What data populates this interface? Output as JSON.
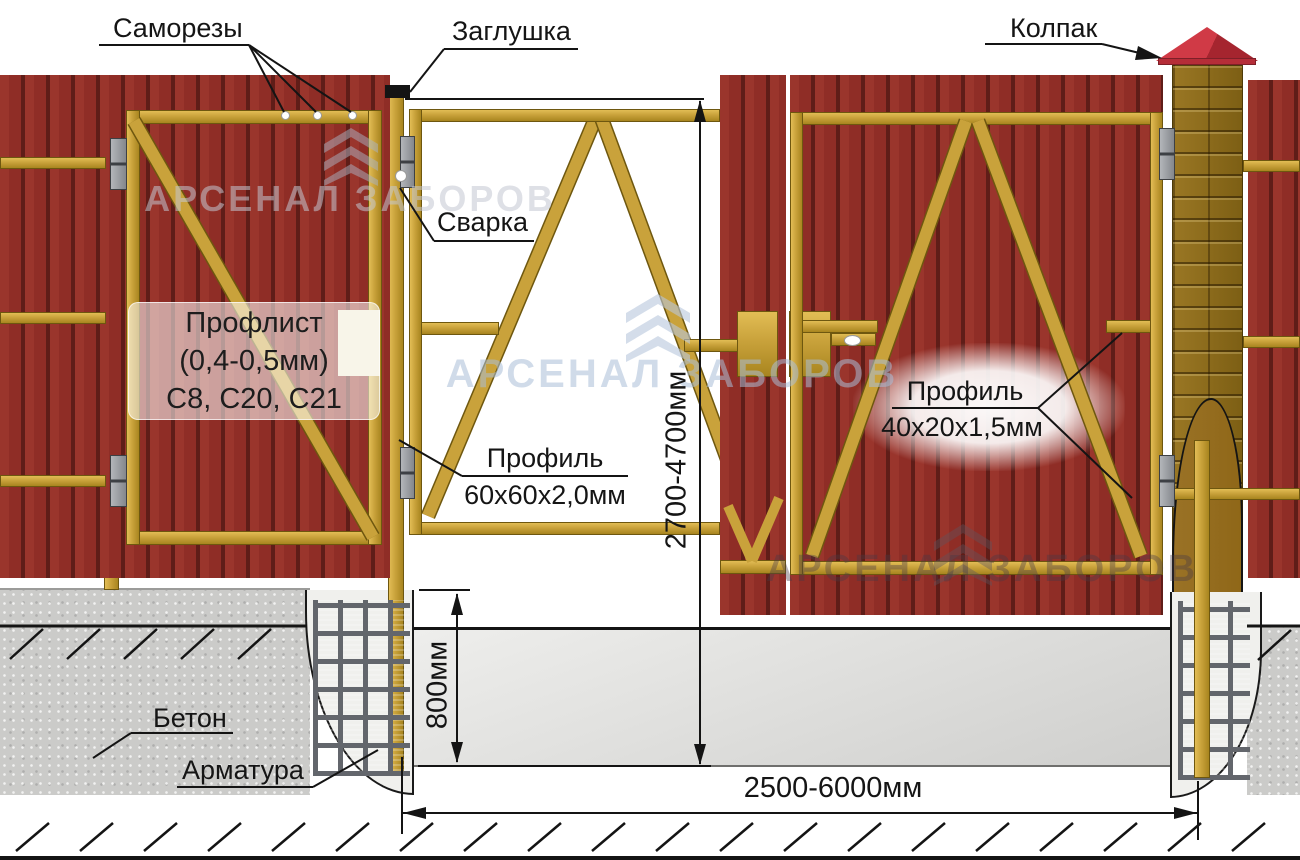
{
  "annotations": {
    "screws": "Саморезы",
    "plug": "Заглушка",
    "cap": "Колпак",
    "weld": "Сварка",
    "concrete": "Бетон",
    "rebar": "Арматура",
    "sheet": {
      "title": "Профлист",
      "thickness": "(0,4-0,5мм)",
      "grades": "С8, С20, С21"
    },
    "post_profile": {
      "title": "Профиль",
      "size": "60х60х2,0мм"
    },
    "frame_profile": {
      "title": "Профиль",
      "size": "40х20х1,5мм"
    }
  },
  "dimensions": {
    "gate_height": "2700-4700мм",
    "foundation_depth": "800мм",
    "span_width": "2500-6000мм"
  },
  "watermark": {
    "text": "АРСЕНАЛ ЗАБОРОВ"
  },
  "colors": {
    "sheet_red": "#8f2d26",
    "sheet_groove": "#5f1d18",
    "sheet_hl": "#9a352c",
    "frame_gold": "#c9a23b",
    "gold_light": "#e2bd55",
    "gold_dark": "#a8851f",
    "brick_brown": "#8c681c",
    "cutaway_brown": "#8f6718",
    "cap_red": "#c8333f",
    "concrete_gray": "#cbcbc9",
    "hinge_gray": "#84878c",
    "rebar_gray": "#63666c",
    "line_black": "#141414"
  }
}
